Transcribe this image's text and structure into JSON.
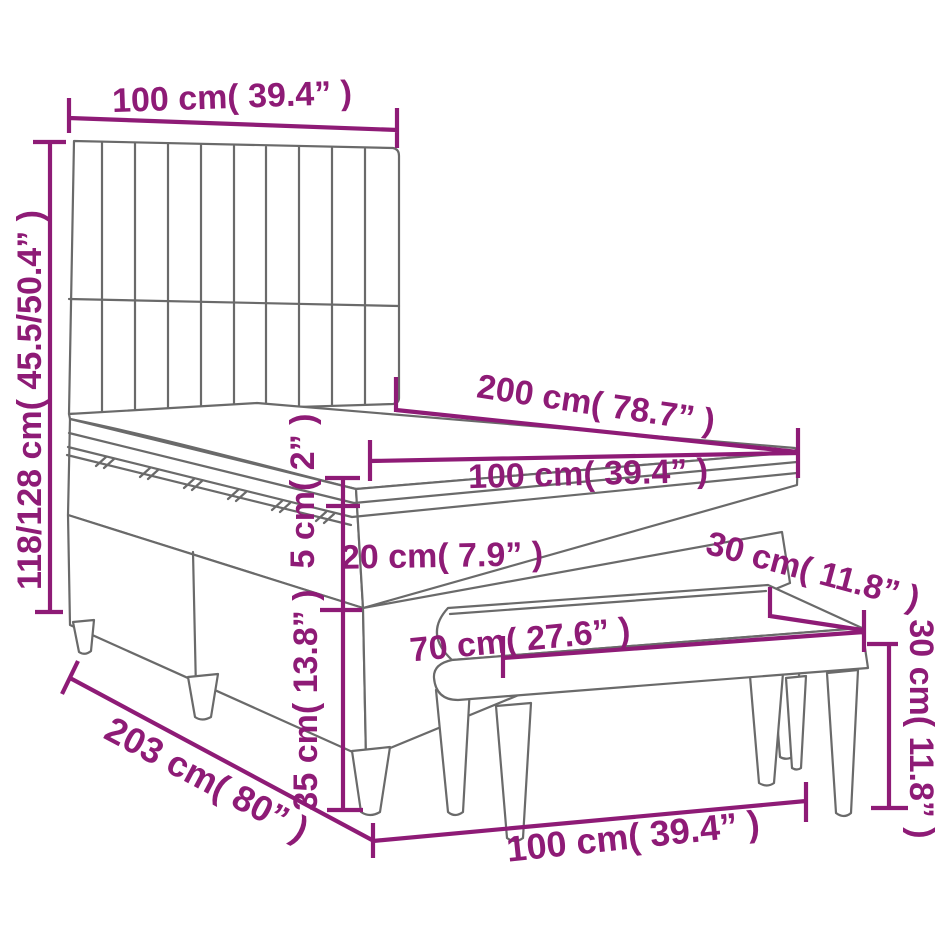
{
  "diagram": {
    "description": "Box spring bed with headboard, pillow-top mattress and upholstered bench – dimension line drawing",
    "accent_color": "#8e1b76",
    "line_color": "#6a6a6a",
    "background": "#ffffff",
    "dimensions": [
      {
        "id": "headboard-width",
        "value_cm": "100",
        "value_in": "39.4",
        "label": "100 cm( 39.4” )"
      },
      {
        "id": "overall-height",
        "value_cm": "118/128",
        "value_in": "45.5/50.4",
        "label": "118/128 cm( 45.5/50.4” )"
      },
      {
        "id": "bed-length",
        "value_cm": "200",
        "value_in": "78.7",
        "label": "200 cm( 78.7” )"
      },
      {
        "id": "mattress-width",
        "value_cm": "100",
        "value_in": "39.4",
        "label": "100 cm( 39.4” )"
      },
      {
        "id": "topper-thickness",
        "value_cm": "5",
        "value_in": "2",
        "label": "5 cm( 2” )"
      },
      {
        "id": "mattress-thickness",
        "value_cm": "20",
        "value_in": "7.9",
        "label": "20 cm( 7.9” )"
      },
      {
        "id": "bench-seat-depth",
        "value_cm": "30",
        "value_in": "11.8",
        "label": "30 cm( 11.8” )"
      },
      {
        "id": "bench-length",
        "value_cm": "70",
        "value_in": "27.6",
        "label": "70 cm( 27.6” )"
      },
      {
        "id": "bench-height",
        "value_cm": "30",
        "value_in": "11.8",
        "label": "30 cm( 11.8” )"
      },
      {
        "id": "base-height",
        "value_cm": "35",
        "value_in": "13.8",
        "label": "35 cm( 13.8” )"
      },
      {
        "id": "total-length",
        "value_cm": "203",
        "value_in": "80",
        "label": "203 cm( 80” )"
      },
      {
        "id": "bed-width",
        "value_cm": "100",
        "value_in": "39.4",
        "label": "100 cm( 39.4” )"
      }
    ]
  }
}
